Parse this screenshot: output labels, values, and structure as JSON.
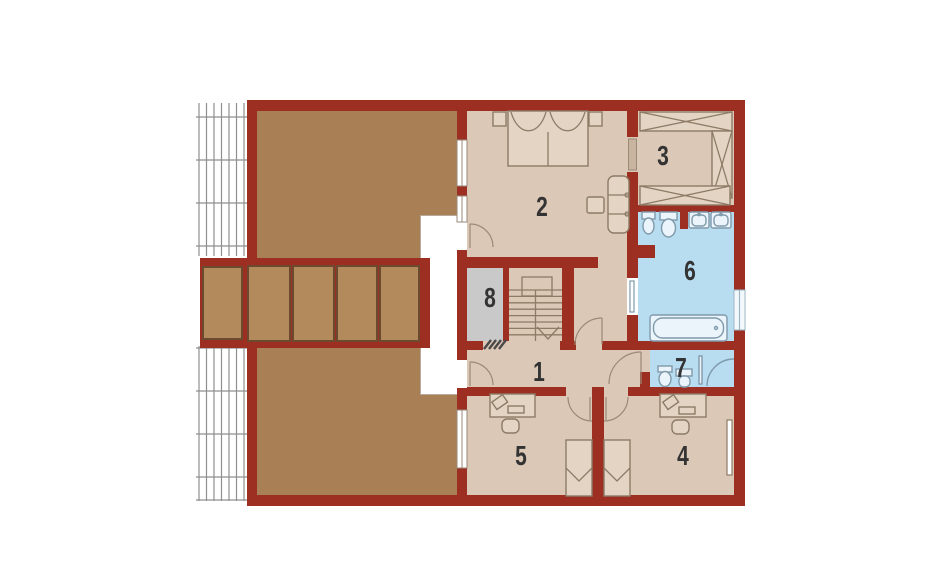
{
  "rooms": [
    {
      "label": "1"
    },
    {
      "label": "2"
    },
    {
      "label": "3"
    },
    {
      "label": "4"
    },
    {
      "label": "5"
    },
    {
      "label": "6"
    },
    {
      "label": "7"
    },
    {
      "label": "8"
    }
  ],
  "colors": {
    "wall": "#9d2e22",
    "floor": "#dcc8b6",
    "floor_light": "#e4d4c3",
    "attic": "#a97f55",
    "panel": "#b28a5c",
    "panel_border": "#6b4a30",
    "bath": "#b8dcf0",
    "fixture": "#7f9aaa",
    "fixture_fill": "#eaf4fa",
    "storage": "#c9c9c9",
    "furniture": "#8c7b66",
    "hatch": "#8f8f8f",
    "label": "#333333",
    "background": "#ffffff"
  },
  "fixtures": [
    "double-bed",
    "nightstand",
    "sofa",
    "coffee-table",
    "wardrobe-cabinet",
    "bidet",
    "toilet",
    "washbasin",
    "double-washbasin",
    "bathtub",
    "corner-shower",
    "desk",
    "office-chair",
    "laptop",
    "single-bed",
    "radiator",
    "staircase",
    "door-swing",
    "sliding-door",
    "window",
    "roof-hatching",
    "terrace-decking",
    "threshold-hatch",
    "stair-direction-arrow"
  ]
}
